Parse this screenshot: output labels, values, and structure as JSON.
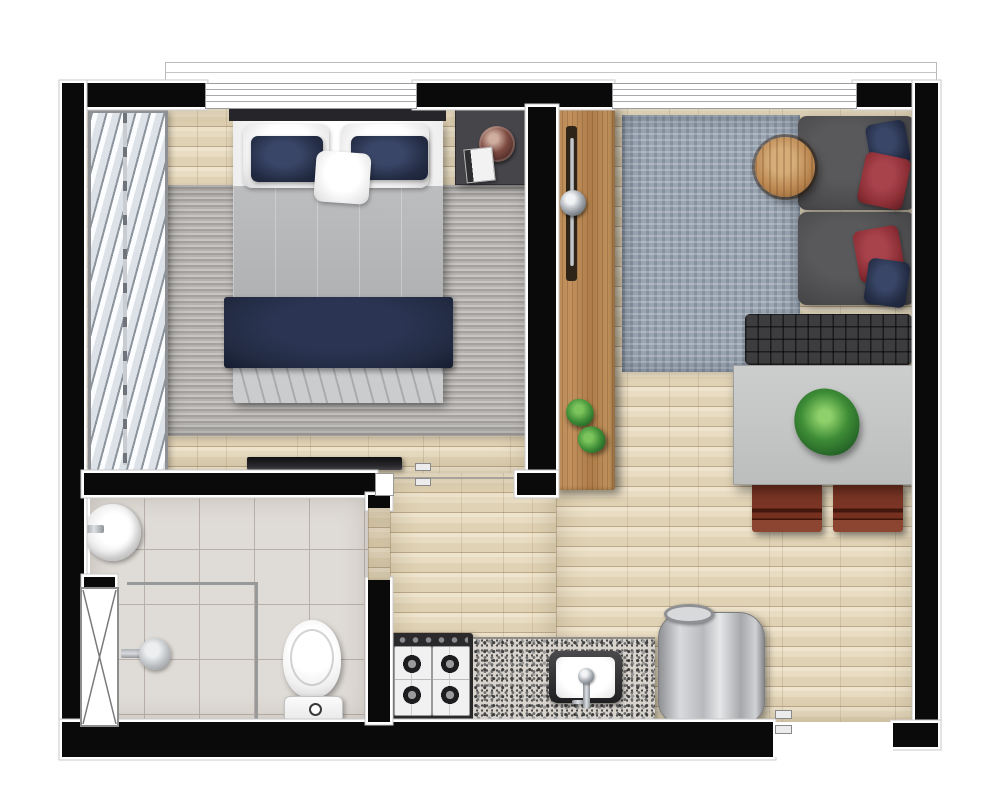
{
  "document": {
    "kind": "apartment-floor-plan-top-view",
    "visible_text": [],
    "rooms": [
      {
        "id": "bedroom",
        "furniture": [
          "double-bed",
          "headboard",
          "white-pillows",
          "navy-pillows",
          "center-pillow",
          "gray-duvet",
          "navy-foot-runner",
          "striped-gray-rug",
          "nightstand",
          "copper-decor-bowl",
          "book",
          "wall-tv",
          "louvered-blinds-closet",
          "top-window"
        ]
      },
      {
        "id": "hall",
        "furniture": [
          "wood-sliding-door-panel",
          "door-handle-knob",
          "floor-plant",
          "floor-plant"
        ]
      },
      {
        "id": "living-dining",
        "furniture": [
          "two-seat-sofa",
          "navy-throw-pillows",
          "red-throw-pillows",
          "round-wood-side-table",
          "mottled-blue-gray-rug",
          "tufted-bench",
          "dining-table",
          "plant-centerpiece",
          "dining-chair",
          "dining-chair",
          "top-window"
        ]
      },
      {
        "id": "bathroom",
        "furniture": [
          "round-wall-basin",
          "basin-faucet",
          "shower-head",
          "shower-glass-partition",
          "toilet",
          "ventilation-shaft"
        ]
      },
      {
        "id": "kitchen",
        "furniture": [
          "four-burner-gas-cooktop",
          "granite-countertop",
          "kitchen-sink",
          "sink-faucet",
          "stainless-steel-washer"
        ]
      }
    ],
    "openings": [
      "bedroom-sliding-door-opening",
      "bathroom-door-opening",
      "entry-door-opening",
      "bedroom-window",
      "living-room-window"
    ]
  },
  "colors": {
    "wall": "#0a0a0a",
    "wallOutline": "#ffffff",
    "floorWoodLight": "#eadec8",
    "floorWoodDark": "#e0d2b4",
    "bathTile": "#dfdbd6",
    "tileLine": "#b9b0a9",
    "rugBedroomLight": "#c6c5c3",
    "rugBedroomDark": "#a39f9c",
    "rugLiving": "#9aa5b2",
    "bedSheet": "#f4f4f4",
    "duvet": "#b7b8ba",
    "bedFoot": "#cbccce",
    "navy": "#222b42",
    "pillowRed": "#8e2f36",
    "headboard": "#26262a",
    "nightstand": "#45454a",
    "copperBowl": "#7c4a41",
    "panelWood": "#c2915d",
    "panelGroove": "#2f2418",
    "woodDoorPanelHandle": "#9aa0a6",
    "sofaGray": "#4c4c4e",
    "sideTableWood": "#bb8751",
    "benchGray": "#3d3d3f",
    "diningTable": "#c6c7c7",
    "chairWood": "#76301f",
    "plantGreen": "#3d8c36",
    "plantDark": "#1e5723",
    "granite": "#d8d4cd",
    "stoveFrame": "#2a2a2c",
    "steel": "#b7b9bc",
    "fixtureWhite": "#f7f7f7",
    "glassLine": "#98999b"
  }
}
